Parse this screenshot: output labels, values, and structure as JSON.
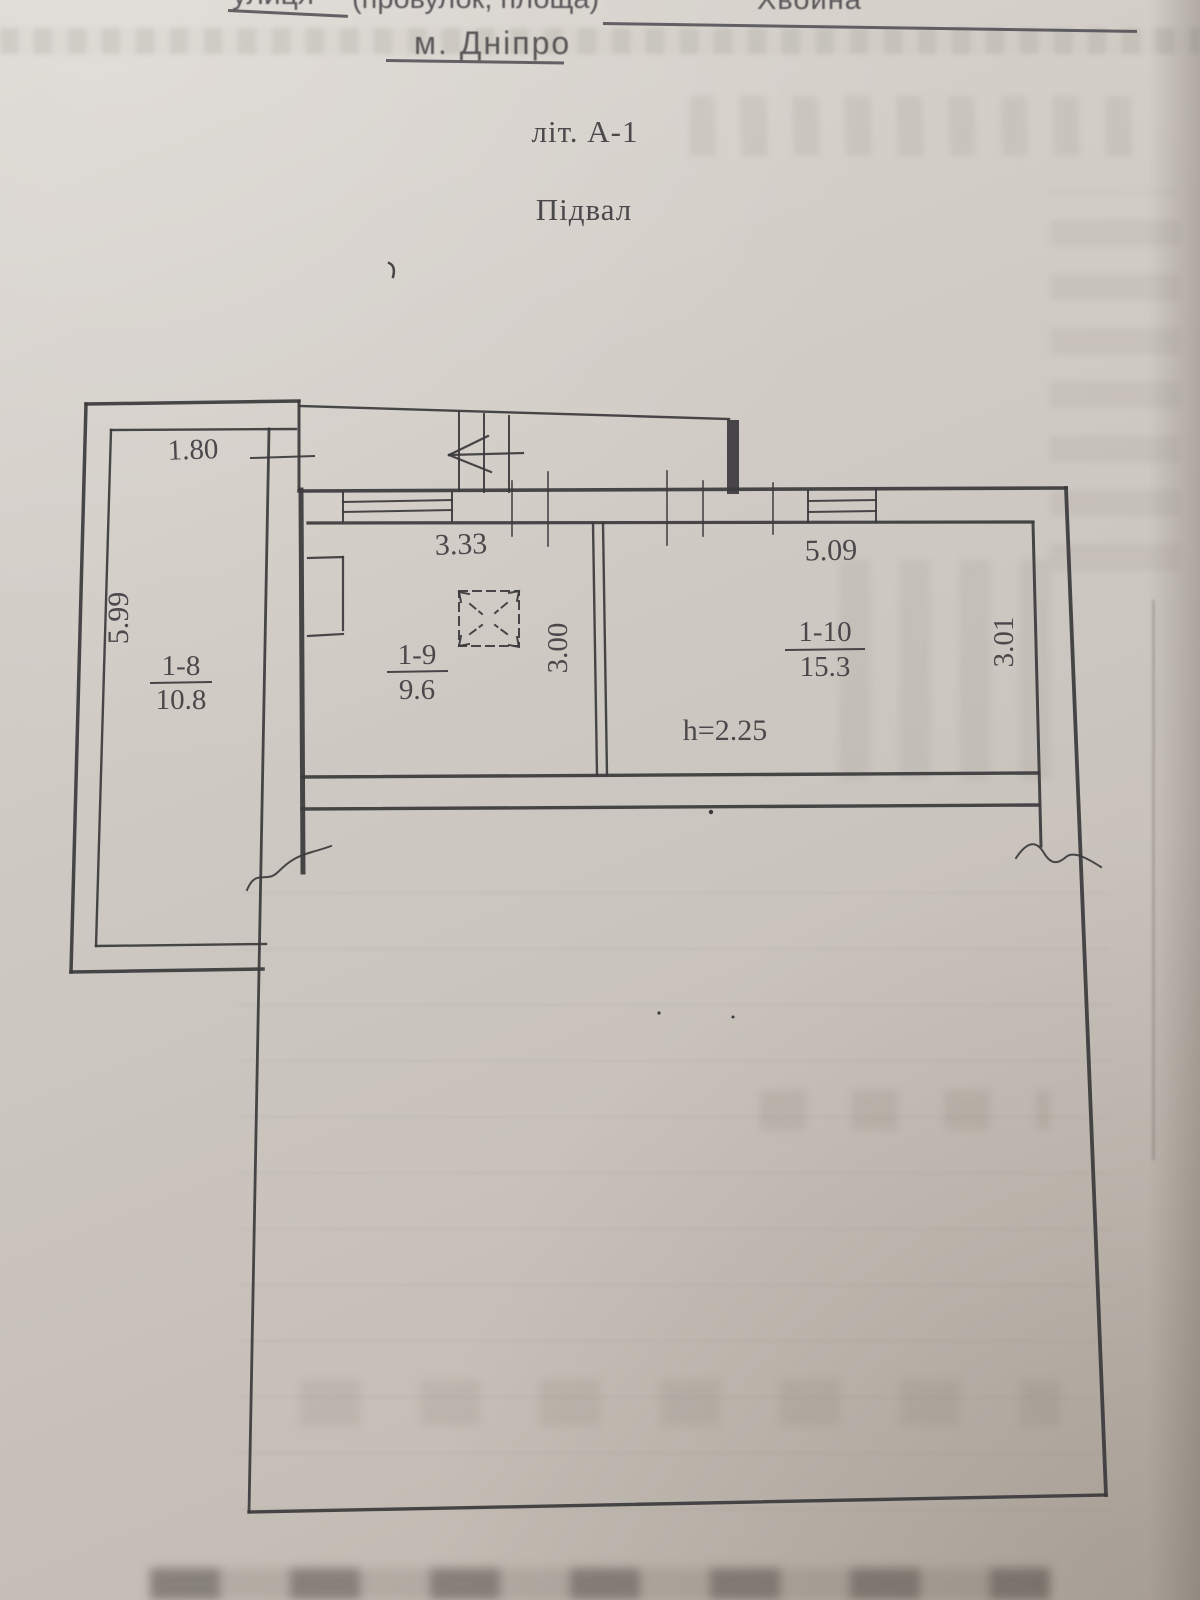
{
  "document": {
    "form_header": {
      "street_word_fragment": "улиця",
      "street_label_rest": "(провулок, площа)",
      "street_name": "Хвойна",
      "city": "м. Дніпро"
    },
    "plan": {
      "building_letter": "літ. А-1",
      "title": "Підвал",
      "height_note": "h=2.25",
      "rooms": [
        {
          "number": "1-8",
          "area": "10.8"
        },
        {
          "number": "1-9",
          "area": "9.6"
        },
        {
          "number": "1-10",
          "area": "15.3"
        }
      ],
      "dimensions": {
        "annex_top_width": "1.80",
        "annex_side_length": "5.99",
        "room_1_9_width": "3.33",
        "room_1_9_depth": "3.00",
        "room_1_10_width": "5.09",
        "room_1_10_depth": "3.01"
      },
      "ink_color": "#3a383b",
      "paper_color": "#cdc7c0"
    }
  }
}
